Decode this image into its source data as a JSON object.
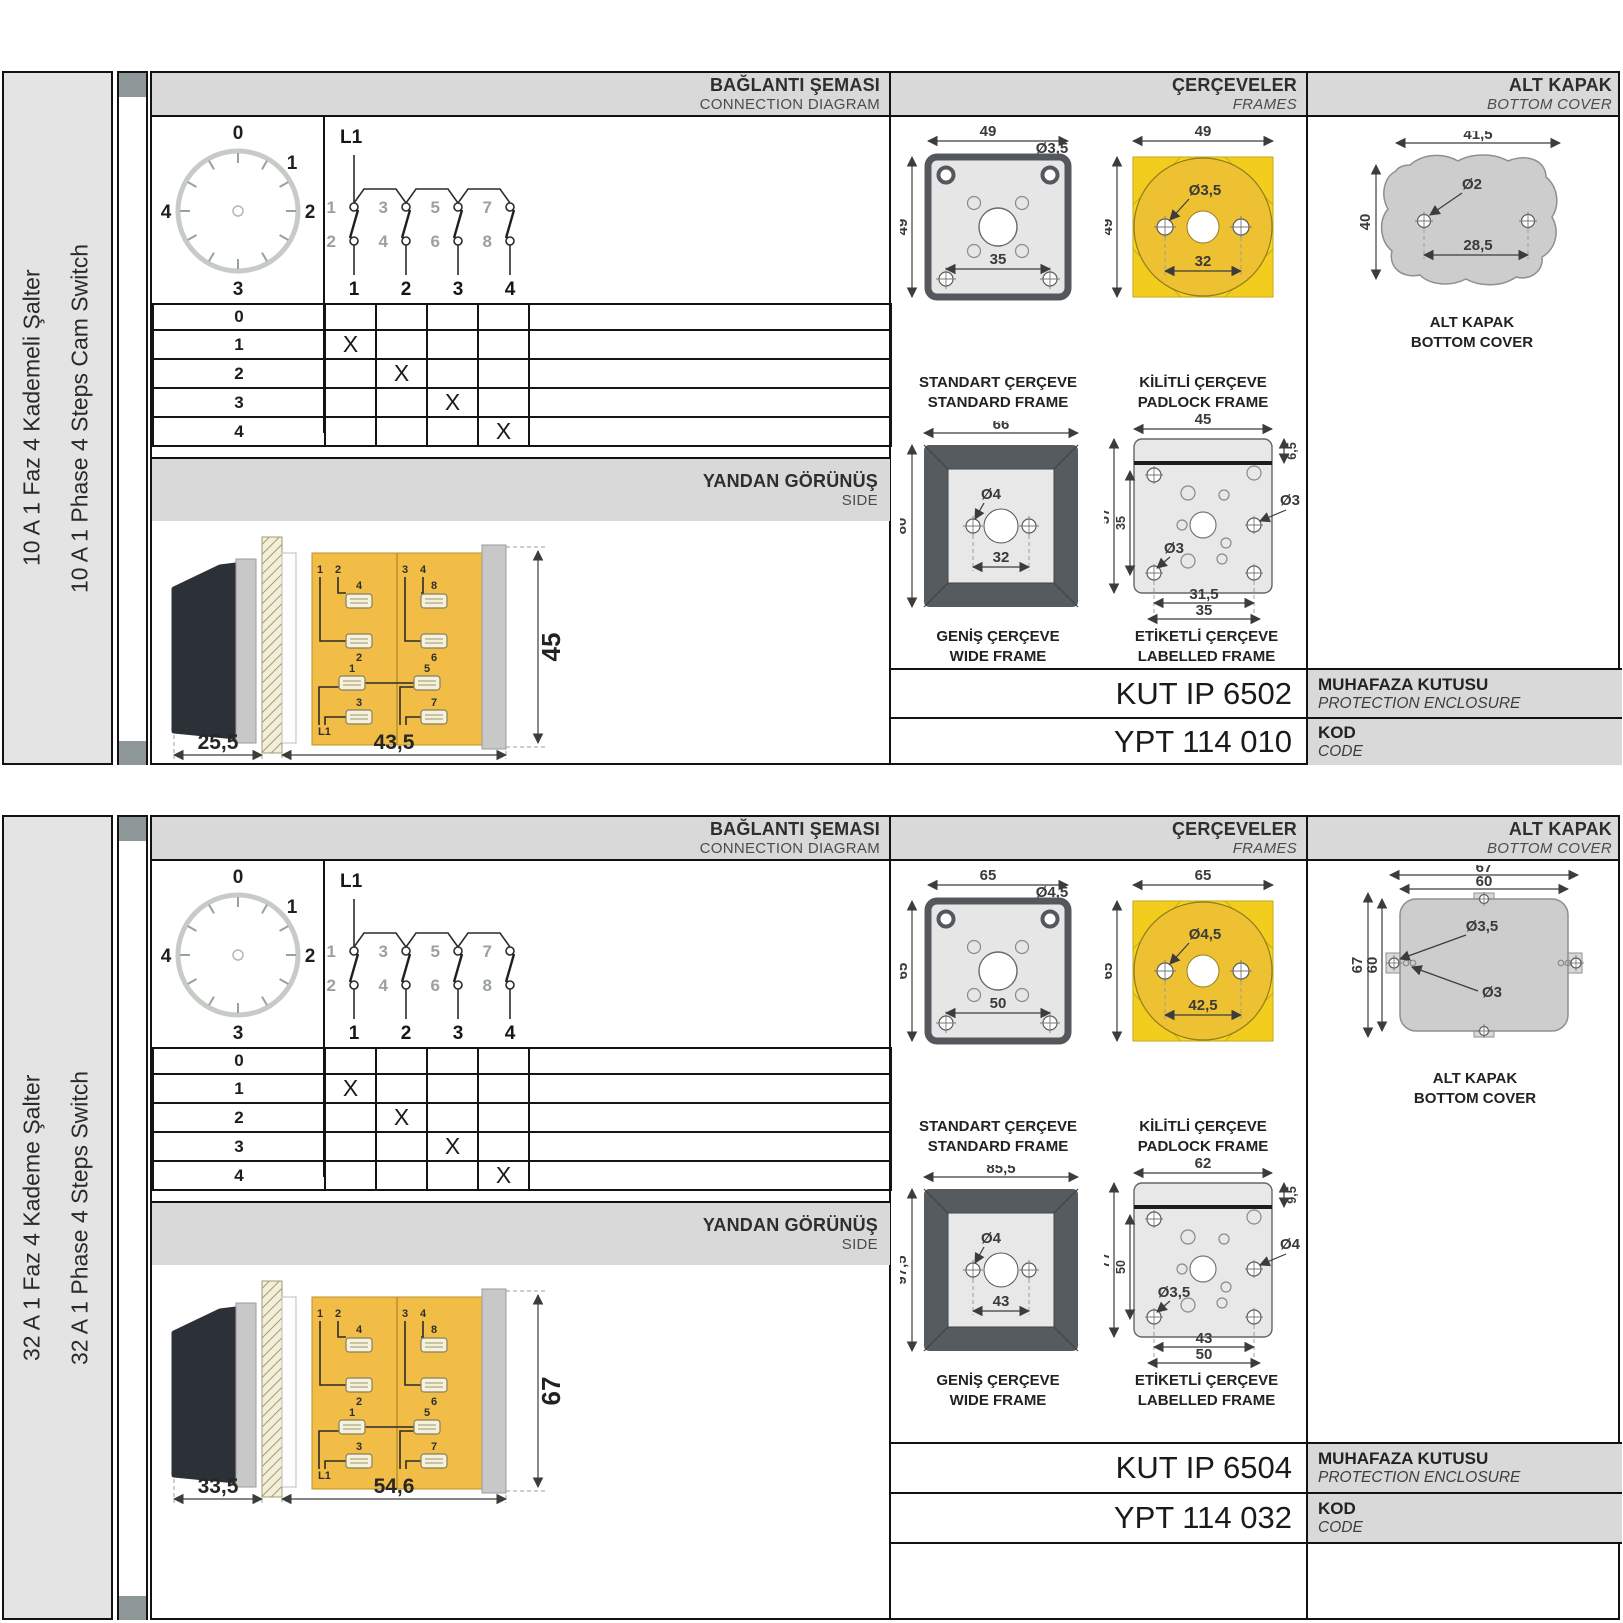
{
  "colors": {
    "band_gray": "#d9d9d9",
    "label_gray": "#e4e4e4",
    "frame_yellow": "#f7d51d",
    "circle_yellow": "#eec133",
    "body_yellow": "#f1bd47",
    "spine_square": "#8d9798"
  },
  "sections": [
    {
      "label_tr": "10 A 1 Faz 4 Kademeli Şalter",
      "label_en": "10 A 1 Phase 4 Steps Cam Switch",
      "headers": {
        "conn_tr": "BAĞLANTI ŞEMASI",
        "conn_en": "CONNECTION DIAGRAM",
        "frames_tr": "ÇERÇEVELER",
        "frames_en": "FRAMES",
        "cover_tr": "ALT KAPAK",
        "cover_en": "BOTTOM COVER"
      },
      "dial": {
        "p0": "0",
        "p1": "1",
        "p2": "2",
        "p3": "3",
        "p4": "4"
      },
      "circuit": {
        "l1": "L1",
        "t1": "1",
        "t2": "3",
        "t3": "5",
        "t4": "7",
        "b1": "2",
        "b2": "4",
        "b3": "6",
        "b4": "8",
        "o1": "1",
        "o2": "2",
        "o3": "3",
        "o4": "4"
      },
      "table": {
        "rows": [
          {
            "label": "0",
            "m": [
              "",
              "",
              "",
              ""
            ]
          },
          {
            "label": "1",
            "m": [
              "X",
              "",
              "",
              ""
            ]
          },
          {
            "label": "2",
            "m": [
              "",
              "X",
              "",
              ""
            ]
          },
          {
            "label": "3",
            "m": [
              "",
              "",
              "X",
              ""
            ]
          },
          {
            "label": "4",
            "m": [
              "",
              "",
              "",
              "X"
            ]
          }
        ]
      },
      "side": {
        "band_tr": "YANDAN GÖRÜNÜŞ",
        "band_en": "SIDE",
        "dim_a": "25,5",
        "dim_b": "43,5",
        "dim_h": "45",
        "c1": "1",
        "c2": "2",
        "c3": "3",
        "c4": "4",
        "t4": "4",
        "t2": "2",
        "t1": "1",
        "t3": "3",
        "t8": "8",
        "t6": "6",
        "t5": "5",
        "t7": "7",
        "l1": "L1"
      },
      "frames": {
        "standard": {
          "cap_tr": "STANDART ÇERÇEVE",
          "cap_en": "STANDARD FRAME",
          "w": "49",
          "h": "49",
          "inner": "35",
          "hole": "Ø3,5"
        },
        "padlock": {
          "cap_tr": "KİLİTLİ ÇERÇEVE",
          "cap_en": "PADLOCK FRAME",
          "w": "49",
          "h": "49",
          "inner": "32",
          "hole": "Ø3,5"
        },
        "wide": {
          "cap_tr": "GENİŞ ÇERÇEVE",
          "cap_en": "WIDE FRAME",
          "w": "66",
          "h": "80",
          "inner": "32",
          "hole": "Ø4"
        },
        "labelled": {
          "cap_tr": "ETİKETLİ ÇERÇEVE",
          "cap_en": "LABELLED FRAME",
          "w": "45",
          "strip": "6,5",
          "h1": "57",
          "h2": "35",
          "b1": "31,5",
          "b2": "35",
          "hole1": "Ø3",
          "hole2": "Ø3"
        }
      },
      "cover": {
        "cap_tr": "ALT KAPAK",
        "cap_en": "BOTTOM COVER",
        "w": "41,5",
        "h": "40",
        "hole": "Ø2",
        "inner": "28,5"
      },
      "codes": {
        "enc_val": "KUT IP 6502",
        "enc_tr": "MUHAFAZA KUTUSU",
        "enc_en": "PROTECTION ENCLOSURE",
        "code_val": "YPT 114 010",
        "code_tr": "KOD",
        "code_en": "CODE"
      }
    },
    {
      "label_tr": "32 A 1 Faz 4 Kademe Şalter",
      "label_en": "32 A 1 Phase 4 Steps Switch",
      "headers": {
        "conn_tr": "BAĞLANTI ŞEMASI",
        "conn_en": "CONNECTION DIAGRAM",
        "frames_tr": "ÇERÇEVELER",
        "frames_en": "FRAMES",
        "cover_tr": "ALT KAPAK",
        "cover_en": "BOTTOM COVER"
      },
      "dial": {
        "p0": "0",
        "p1": "1",
        "p2": "2",
        "p3": "3",
        "p4": "4"
      },
      "circuit": {
        "l1": "L1",
        "t1": "1",
        "t2": "3",
        "t3": "5",
        "t4": "7",
        "b1": "2",
        "b2": "4",
        "b3": "6",
        "b4": "8",
        "o1": "1",
        "o2": "2",
        "o3": "3",
        "o4": "4"
      },
      "table": {
        "rows": [
          {
            "label": "0",
            "m": [
              "",
              "",
              "",
              ""
            ]
          },
          {
            "label": "1",
            "m": [
              "X",
              "",
              "",
              ""
            ]
          },
          {
            "label": "2",
            "m": [
              "",
              "X",
              "",
              ""
            ]
          },
          {
            "label": "3",
            "m": [
              "",
              "",
              "X",
              ""
            ]
          },
          {
            "label": "4",
            "m": [
              "",
              "",
              "",
              "X"
            ]
          }
        ]
      },
      "side": {
        "band_tr": "YANDAN GÖRÜNÜŞ",
        "band_en": "SIDE",
        "dim_a": "33,5",
        "dim_b": "54,6",
        "dim_h": "67",
        "c1": "1",
        "c2": "2",
        "c3": "3",
        "c4": "4",
        "t4": "4",
        "t2": "2",
        "t1": "1",
        "t3": "3",
        "t8": "8",
        "t6": "6",
        "t5": "5",
        "t7": "7",
        "l1": "L1"
      },
      "frames": {
        "standard": {
          "cap_tr": "STANDART ÇERÇEVE",
          "cap_en": "STANDARD FRAME",
          "w": "65",
          "h": "65",
          "inner": "50",
          "hole": "Ø4,5"
        },
        "padlock": {
          "cap_tr": "KİLİTLİ ÇERÇEVE",
          "cap_en": "PADLOCK FRAME",
          "w": "65",
          "h": "65",
          "inner": "42,5",
          "hole": "Ø4,5"
        },
        "wide": {
          "cap_tr": "GENİŞ ÇERÇEVE",
          "cap_en": "WIDE FRAME",
          "w": "85,5",
          "h": "97,5",
          "inner": "43",
          "hole": "Ø4"
        },
        "labelled": {
          "cap_tr": "ETİKETLİ ÇERÇEVE",
          "cap_en": "LABELLED FRAME",
          "w": "62",
          "strip": "9,5",
          "h1": "77",
          "h2": "50",
          "b1": "43",
          "b2": "50",
          "hole1": "Ø4",
          "hole2": "Ø3,5"
        }
      },
      "cover": {
        "cap_tr": "ALT KAPAK",
        "cap_en": "BOTTOM COVER",
        "w1": "67",
        "w2": "60",
        "h1": "67",
        "h2": "60",
        "hole1": "Ø3,5",
        "hole2": "Ø3"
      },
      "codes": {
        "enc_val": "KUT IP 6504",
        "enc_tr": "MUHAFAZA KUTUSU",
        "enc_en": "PROTECTION ENCLOSURE",
        "code_val": "YPT 114 032",
        "code_tr": "KOD",
        "code_en": "CODE"
      }
    }
  ]
}
